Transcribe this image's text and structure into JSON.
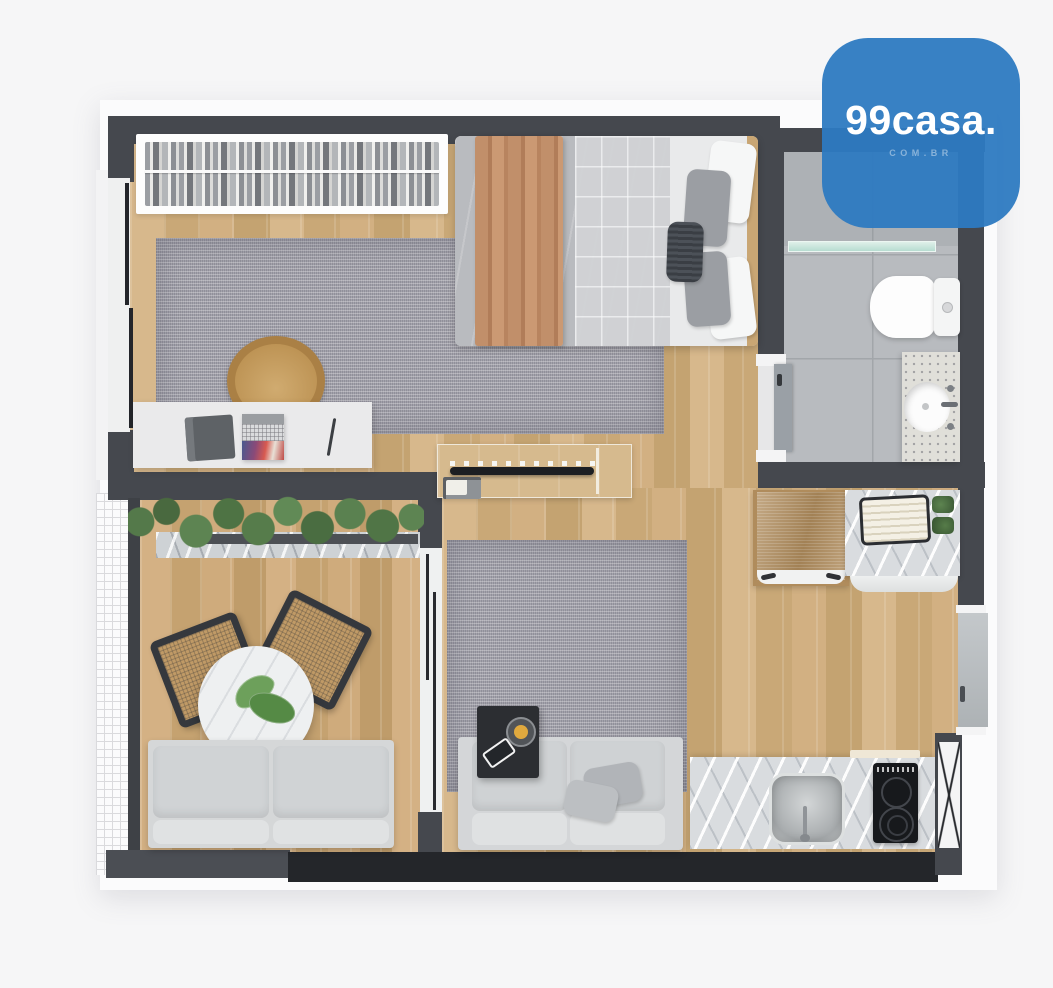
{
  "logo": {
    "brand": "99casa.",
    "domain": "COM.BR",
    "background_color": "#2d7ac1",
    "text_color": "#ffffff"
  },
  "scene": {
    "type": "3d-top-view-apartment-floor-plan",
    "rooms": [
      "bedroom",
      "bathroom",
      "living-room",
      "kitchen",
      "balcony"
    ]
  },
  "palette": {
    "page_background": "#f6f6f7",
    "wall_dark": "#45484e",
    "wall_darkest": "#24262a",
    "wood_floor": "#cfae81",
    "rug_gray": "#a3a2ab",
    "bathroom_tile": "#b8bbbf",
    "marble_counter": "#d9dcdf",
    "sofa_gray": "#d5d7d8",
    "blanket_tan": "#c08a66",
    "plant_green": "#567c49",
    "brand_blue": "#2d7ac1"
  }
}
